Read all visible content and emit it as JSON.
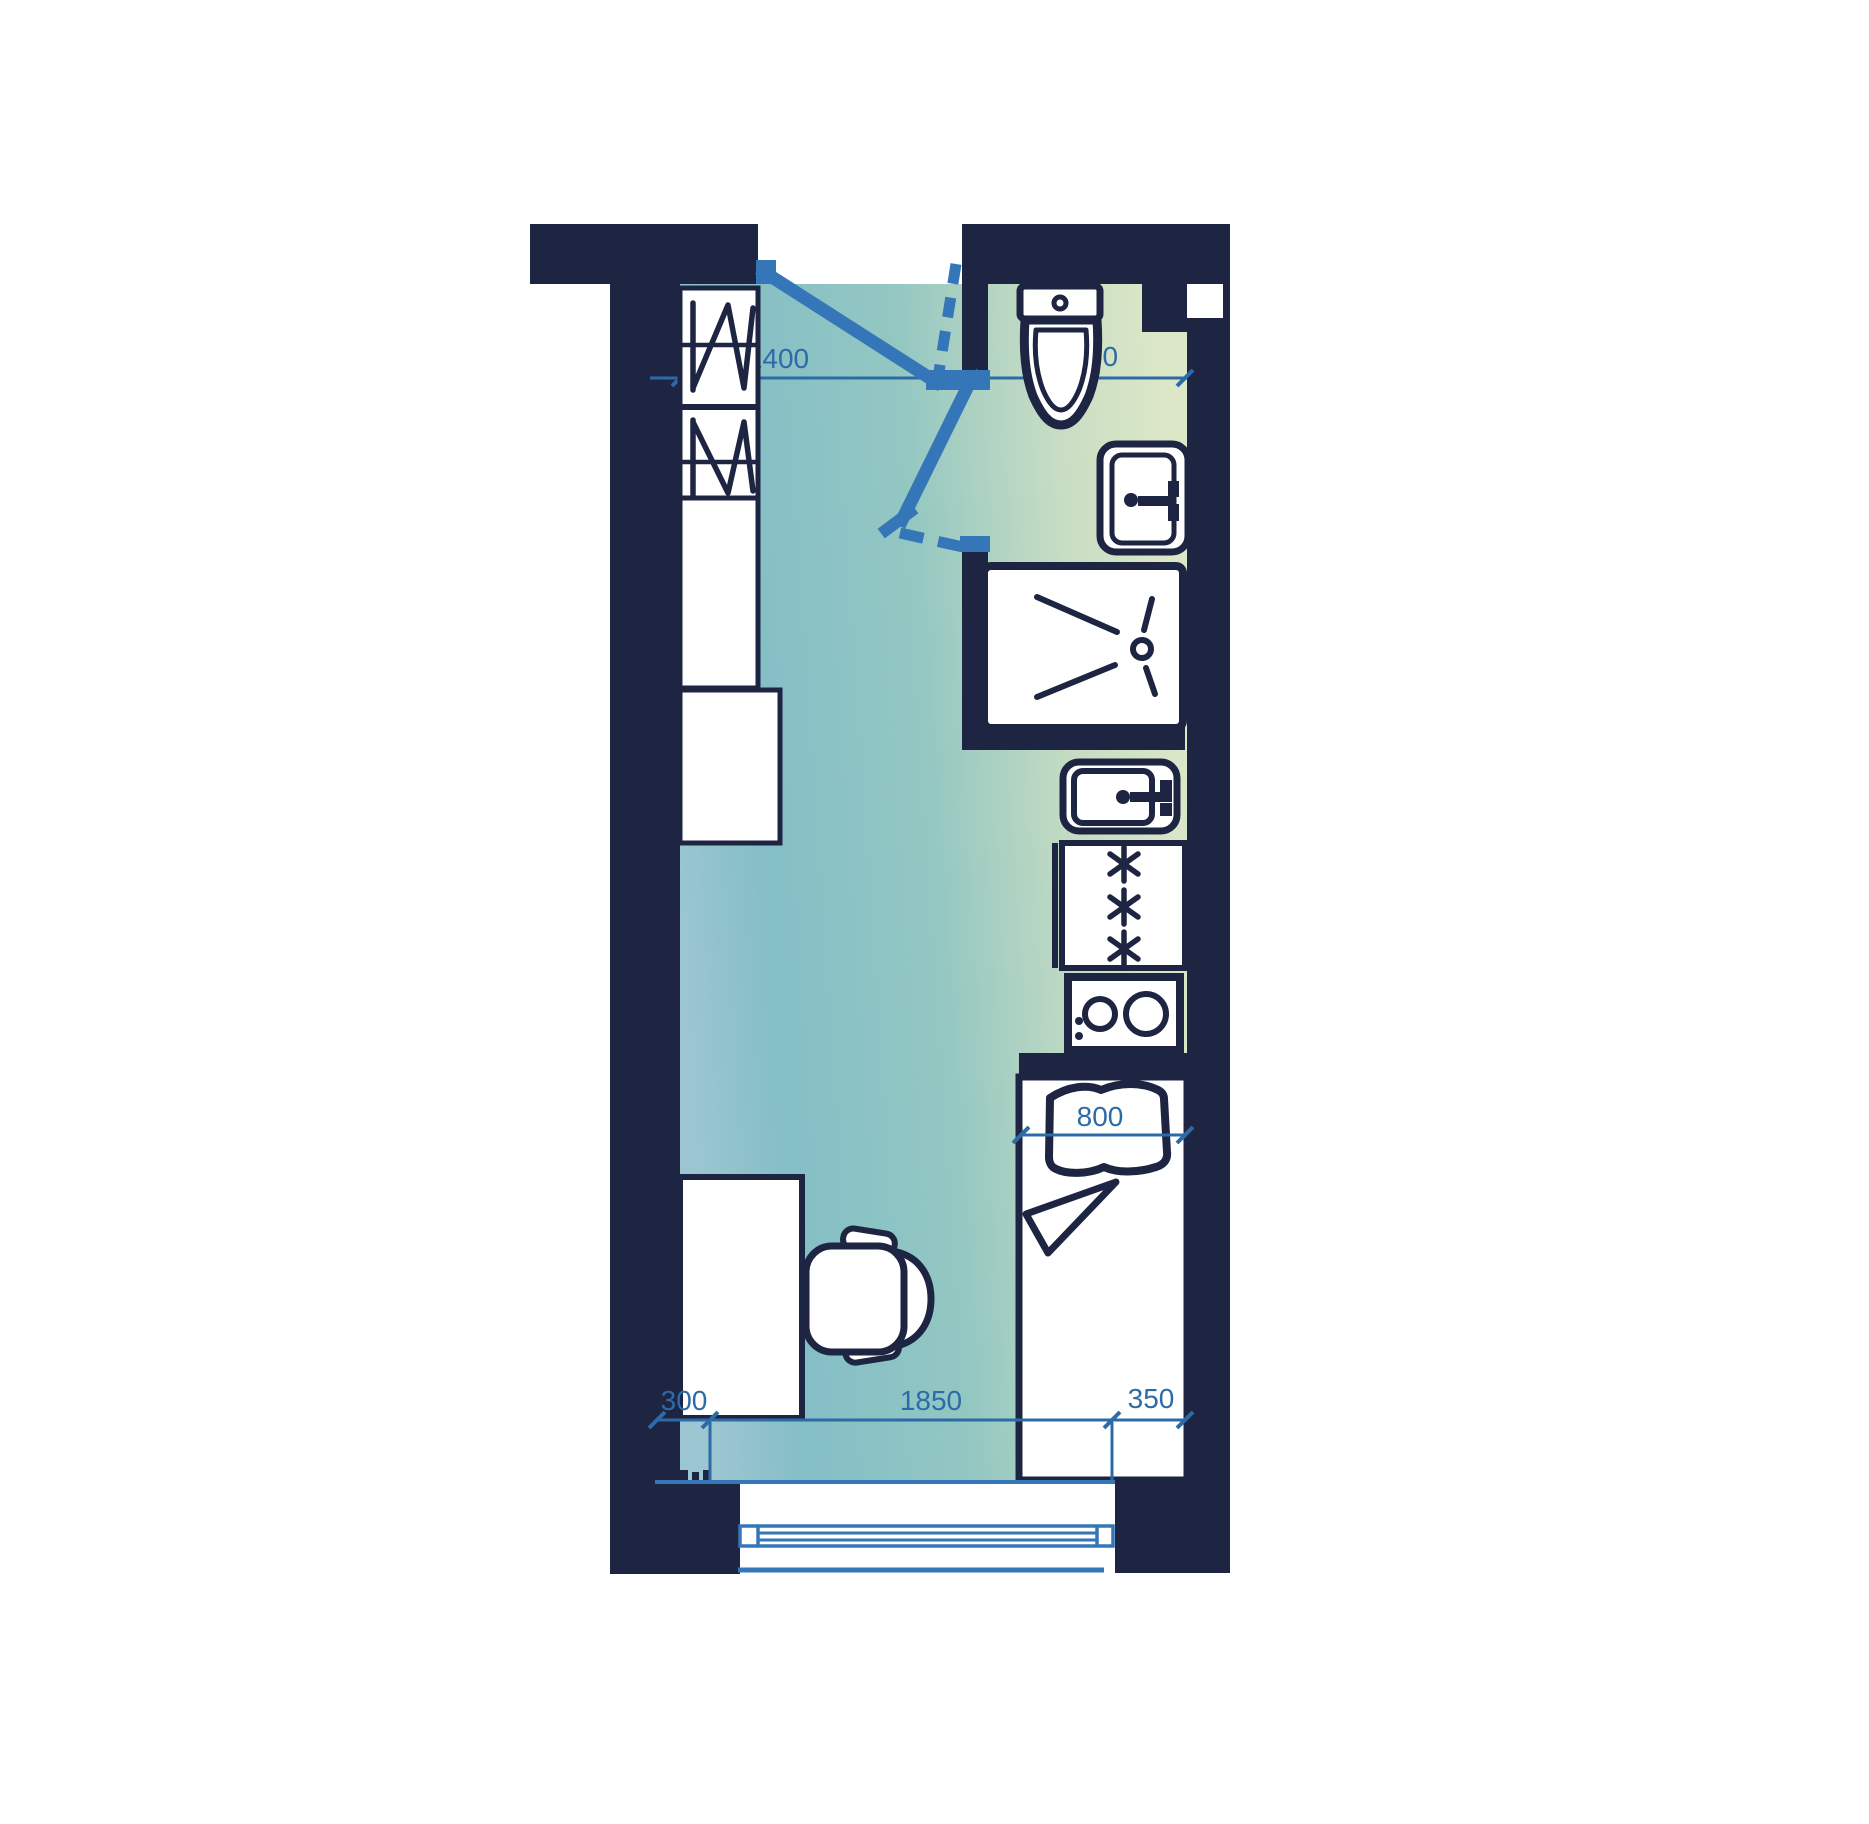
{
  "plan": {
    "dimensions": {
      "d1400": "1400",
      "d1000": "1000",
      "d800": "800",
      "d300": "300",
      "d1850": "1850",
      "d350": "350"
    },
    "fixture_symbols": [
      "wardrobe-symbol",
      "entry-door-symbol",
      "bathroom-door-symbol",
      "toilet-symbol",
      "washbasin-symbol",
      "shower-tray-symbol",
      "kitchen-sink-symbol",
      "fridge-freezer-symbol",
      "stove-symbol",
      "bed-symbol",
      "pillow-symbol",
      "blanket-symbol",
      "desk-symbol",
      "office-chair-symbol",
      "window-symbol"
    ],
    "colors": {
      "wall": "#1e2542",
      "door_blue": "#3576b8",
      "dimension_blue": "#2d6ba6",
      "fixture_fill": "#ffffff",
      "floor_teal": "#84bec6",
      "floor_green": "#dbe7c7",
      "floor_light_blue": "#9cc6d2",
      "background": "#ffffff"
    }
  }
}
